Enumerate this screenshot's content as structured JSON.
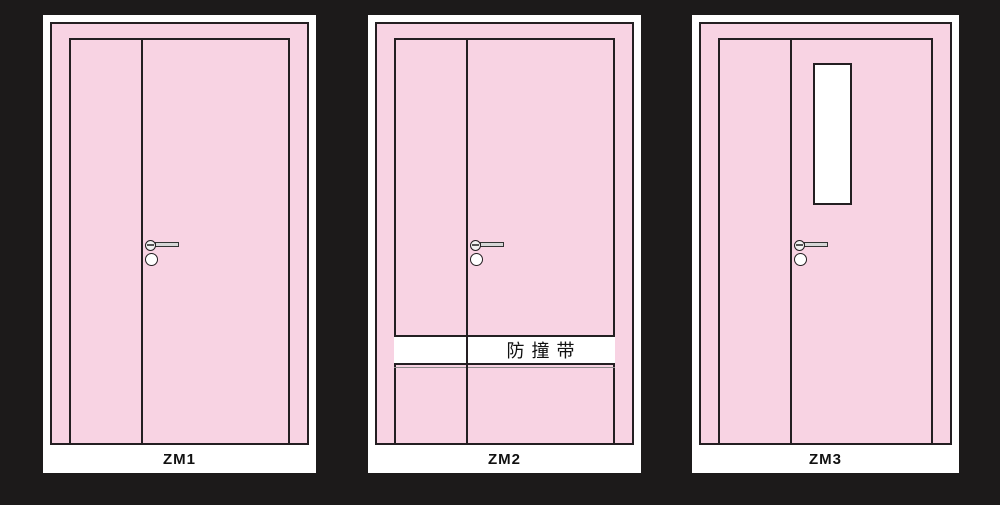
{
  "colors": {
    "background": "#1c1a1a",
    "card_background": "#ffffff",
    "door_pink": "#f8d3e3",
    "outline": "#241f22",
    "band_background": "#ffffff",
    "window_background": "#ffffff",
    "label_text": "#111111"
  },
  "doors": [
    {
      "label": "ZM1"
    },
    {
      "label": "ZM2",
      "band_text": "防撞带"
    },
    {
      "label": "ZM3"
    }
  ]
}
